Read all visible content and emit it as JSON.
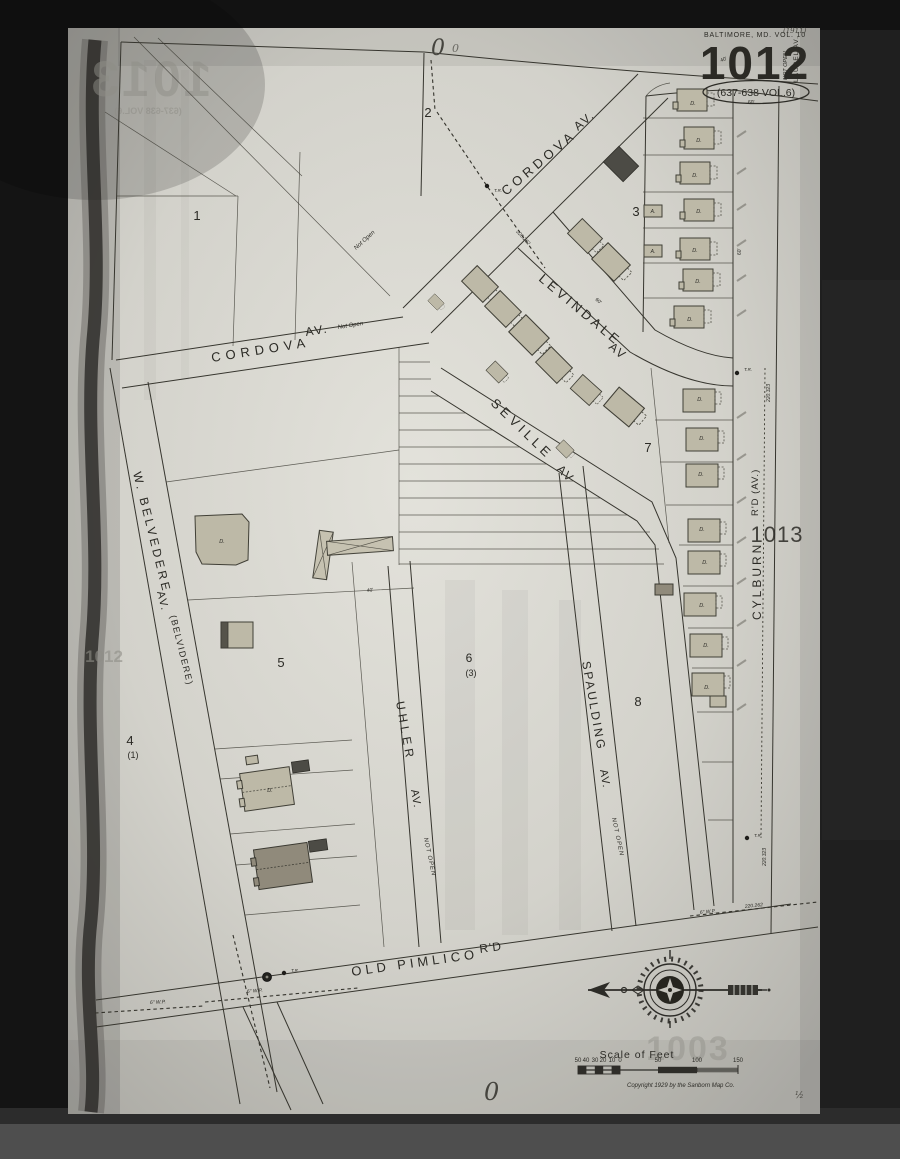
{
  "colors": {
    "backdrop": "#1a1a1a",
    "paper": "#cfcec8",
    "ink": "#36352e",
    "building": "#bdb9a7",
    "building_dark": "#4c4b45",
    "bottom_band": "#4e4e4e"
  },
  "header": {
    "city_line": "BALTIMORE, MD. VOL. 10",
    "sheet_number": "1012",
    "volume_ref": "(637-638 VOL.6)",
    "handwritten_note": "(1911)",
    "margin_not_open": "NOT OPEN",
    "margin_street": "LAUREL AV."
  },
  "adjacent": {
    "right_sheet": "1013"
  },
  "ghosts": {
    "sheet_top_left": "1013",
    "vol_ref": "(637-638 VOL.6)",
    "sheet_left": "1012",
    "sheet_bottom": "1003"
  },
  "hand": {
    "top_zero": "0",
    "top_zero_small": "0",
    "bottom_zero": "0",
    "half_mark": "½"
  },
  "streets": {
    "cordova": {
      "name": "CORDOVA",
      "suffix": "AV."
    },
    "cordova_west": {
      "name": "CORDOVA",
      "suffix": "AV.",
      "status": "Not Open"
    },
    "levindale": {
      "name": "LEVINDALE",
      "suffix": "AV"
    },
    "seville": {
      "name": "SEVILLE",
      "suffix": "AV"
    },
    "belvedere": {
      "name": "W. BELVEDERE",
      "suffix": "AV.",
      "alt": "(BELVIDERE)"
    },
    "cylburn": {
      "name": "CYLBURN",
      "suffix": "R'D (AV.)"
    },
    "old_pimlico": {
      "name": "OLD PIMLICO",
      "suffix": "R'D"
    },
    "uhler": {
      "name": "UHLER",
      "suffix": "AV.",
      "status": "NOT OPEN"
    },
    "spaulding": {
      "name": "SPAULDING",
      "suffix": "AV.",
      "status": "NOT OPEN"
    }
  },
  "blocks": {
    "b1": "1",
    "b2": "2",
    "b3": "3",
    "b4": "4",
    "b4_sub": "(1)",
    "b5": "5",
    "b6": "6",
    "b6_sub": "(3)",
    "b7": "7",
    "b8": "8"
  },
  "annotations": {
    "tr": "T.R.",
    "water_pipe": "6\" W.P.",
    "survey_a": "220.323",
    "survey_b": "220.262",
    "not_open": "Not Open",
    "dim_60": "60'",
    "dim_40": "40'"
  },
  "letters": {
    "dwelling": "D.",
    "auto": "A."
  },
  "scale": {
    "title": "Scale of Feet",
    "ticks": [
      "50",
      "40",
      "30",
      "20",
      "10",
      "0",
      "50",
      "100",
      "150"
    ],
    "copyright": "Copyright 1929 by the Sanborn Map Co."
  }
}
